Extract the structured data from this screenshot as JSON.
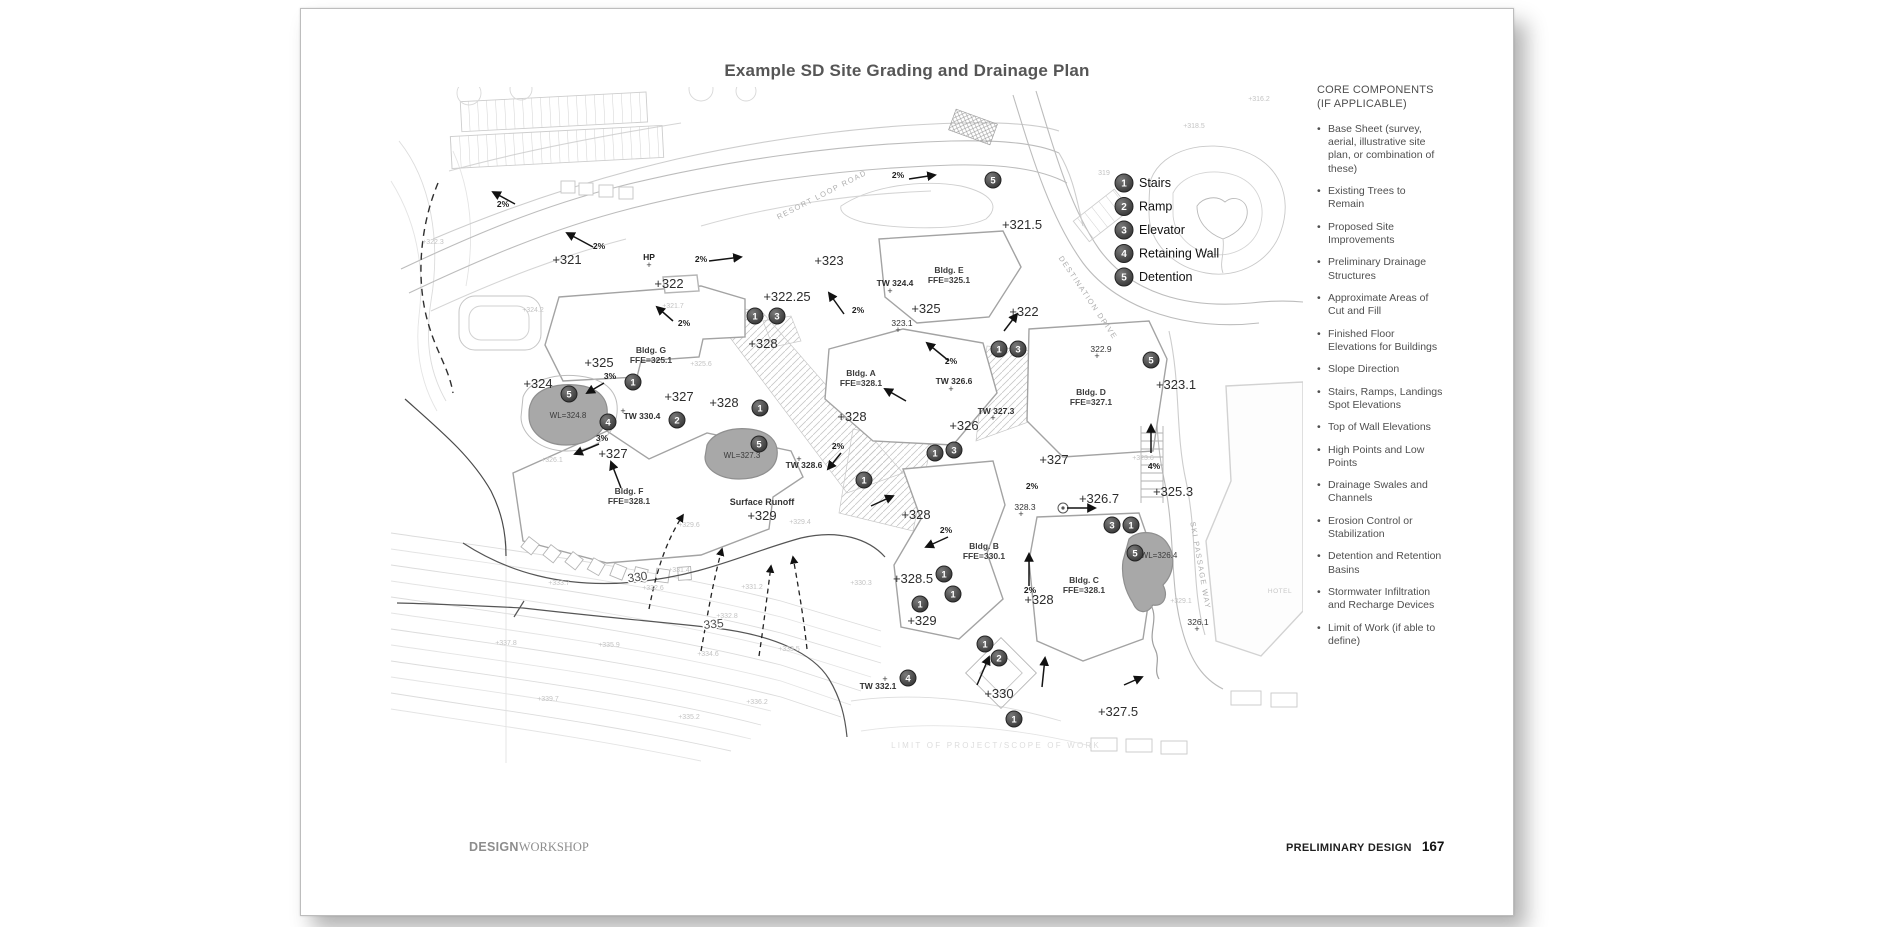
{
  "page": {
    "title": "Example SD Site Grading and Drainage Plan",
    "footer": {
      "brand_bold": "DESIGN",
      "brand_serif": "WORKSHOP",
      "section_label": "PRELIMINARY DESIGN",
      "page_number": "167"
    }
  },
  "legend": {
    "items": [
      {
        "num": "1",
        "label": "Stairs"
      },
      {
        "num": "2",
        "label": "Ramp"
      },
      {
        "num": "3",
        "label": "Elevator"
      },
      {
        "num": "4",
        "label": "Retaining Wall"
      },
      {
        "num": "5",
        "label": "Detention"
      }
    ]
  },
  "sidebar": {
    "heading_line1": "CORE COMPONENTS",
    "heading_line2": "(IF APPLICABLE)",
    "items": [
      "Base Sheet (survey, aerial, illustrative site plan, or combination of these)",
      "Existing Trees to Remain",
      "Proposed Site Improvements",
      "Preliminary Drainage Structures",
      "Approximate Areas of Cut and Fill",
      "Finished Floor Elevations for Buildings",
      "Slope Direction",
      "Stairs, Ramps, Landings Spot Elevations",
      "Top of Wall Elevations",
      "High Points and Low Points",
      "Drainage Swales and Channels",
      "Erosion Control or Stabilization",
      "Detention and Retention Basins",
      "Stormwater Infiltration and Recharge Devices",
      "Limit of Work (if able to define)"
    ]
  },
  "plan": {
    "labels": [
      {
        "t": "+321",
        "x": 566,
        "y": 263,
        "c": "spot"
      },
      {
        "t": "+322",
        "x": 668,
        "y": 287,
        "c": "spot"
      },
      {
        "t": "+322.25",
        "x": 786,
        "y": 300,
        "c": "spot"
      },
      {
        "t": "+323",
        "x": 828,
        "y": 264,
        "c": "spot"
      },
      {
        "t": "+321.5",
        "x": 1021,
        "y": 228,
        "c": "spot"
      },
      {
        "t": "+322",
        "x": 1023,
        "y": 315,
        "c": "spot"
      },
      {
        "t": "+325",
        "x": 925,
        "y": 312,
        "c": "spot"
      },
      {
        "t": "+325",
        "x": 598,
        "y": 366,
        "c": "spot"
      },
      {
        "t": "+324",
        "x": 537,
        "y": 387,
        "c": "spot"
      },
      {
        "t": "+327",
        "x": 678,
        "y": 400,
        "c": "spot"
      },
      {
        "t": "+328",
        "x": 723,
        "y": 406,
        "c": "spot"
      },
      {
        "t": "+328",
        "x": 762,
        "y": 347,
        "c": "spot"
      },
      {
        "t": "+327",
        "x": 612,
        "y": 457,
        "c": "spot"
      },
      {
        "t": "+326",
        "x": 963,
        "y": 429,
        "c": "spot"
      },
      {
        "t": "+328",
        "x": 851,
        "y": 420,
        "c": "spot"
      },
      {
        "t": "+327",
        "x": 1053,
        "y": 463,
        "c": "spot"
      },
      {
        "t": "+326.7",
        "x": 1098,
        "y": 502,
        "c": "spot"
      },
      {
        "t": "+325.3",
        "x": 1172,
        "y": 495,
        "c": "spot"
      },
      {
        "t": "+323.1",
        "x": 1175,
        "y": 388,
        "c": "spot"
      },
      {
        "t": "+328",
        "x": 915,
        "y": 518,
        "c": "spot"
      },
      {
        "t": "+328.5",
        "x": 912,
        "y": 582,
        "c": "spot"
      },
      {
        "t": "+329",
        "x": 761,
        "y": 519,
        "c": "spot"
      },
      {
        "t": "+329",
        "x": 921,
        "y": 624,
        "c": "spot"
      },
      {
        "t": "+328",
        "x": 1038,
        "y": 603,
        "c": "spot"
      },
      {
        "t": "+330",
        "x": 998,
        "y": 697,
        "c": "spot"
      },
      {
        "t": "+327.5",
        "x": 1117,
        "y": 715,
        "c": "spot"
      },
      {
        "t": "322.9",
        "x": 1100,
        "y": 351,
        "c": "sm"
      },
      {
        "t": "323.1",
        "x": 901,
        "y": 325,
        "c": "sm"
      },
      {
        "t": "328.3",
        "x": 1024,
        "y": 509,
        "c": "sm"
      },
      {
        "t": "326.1",
        "x": 1197,
        "y": 624,
        "c": "sm"
      },
      {
        "t": "+",
        "x": 1096,
        "y": 358,
        "c": "plus"
      },
      {
        "t": "+",
        "x": 897,
        "y": 332,
        "c": "plus"
      },
      {
        "t": "+",
        "x": 1020,
        "y": 516,
        "c": "plus"
      },
      {
        "t": "+",
        "x": 1196,
        "y": 631,
        "c": "plus"
      },
      {
        "t": "+",
        "x": 889,
        "y": 293,
        "c": "plus"
      },
      {
        "t": "+",
        "x": 950,
        "y": 391,
        "c": "plus"
      },
      {
        "t": "+",
        "x": 992,
        "y": 420,
        "c": "plus"
      },
      {
        "t": "+",
        "x": 798,
        "y": 461,
        "c": "plus"
      },
      {
        "t": "+",
        "x": 884,
        "y": 681,
        "c": "plus"
      },
      {
        "t": "+",
        "x": 622,
        "y": 413,
        "c": "plus"
      },
      {
        "t": "+",
        "x": 648,
        "y": 267,
        "c": "plus"
      },
      {
        "t": "TW 324.4",
        "x": 894,
        "y": 285,
        "c": "tw"
      },
      {
        "t": "TW 330.4",
        "x": 641,
        "y": 418,
        "c": "tw"
      },
      {
        "t": "TW 328.6",
        "x": 803,
        "y": 467,
        "c": "tw"
      },
      {
        "t": "TW 326.6",
        "x": 953,
        "y": 383,
        "c": "tw"
      },
      {
        "t": "TW 327.3",
        "x": 995,
        "y": 413,
        "c": "tw"
      },
      {
        "t": "TW 332.1",
        "x": 877,
        "y": 688,
        "c": "tw"
      },
      {
        "t": "Bldg. G",
        "x": 650,
        "y": 352,
        "c": "bldg"
      },
      {
        "t": "FFE=325.1",
        "x": 650,
        "y": 362,
        "c": "bldg"
      },
      {
        "t": "Bldg. A",
        "x": 860,
        "y": 375,
        "c": "bldg"
      },
      {
        "t": "FFE=328.1",
        "x": 860,
        "y": 385,
        "c": "bldg"
      },
      {
        "t": "Bldg. E",
        "x": 948,
        "y": 272,
        "c": "bldg"
      },
      {
        "t": "FFE=325.1",
        "x": 948,
        "y": 282,
        "c": "bldg"
      },
      {
        "t": "Bldg. D",
        "x": 1090,
        "y": 394,
        "c": "bldg"
      },
      {
        "t": "FFE=327.1",
        "x": 1090,
        "y": 404,
        "c": "bldg"
      },
      {
        "t": "Bldg. F",
        "x": 628,
        "y": 493,
        "c": "bldg"
      },
      {
        "t": "FFE=328.1",
        "x": 628,
        "y": 503,
        "c": "bldg"
      },
      {
        "t": "Bldg. B",
        "x": 983,
        "y": 548,
        "c": "bldg"
      },
      {
        "t": "FFE=330.1",
        "x": 983,
        "y": 558,
        "c": "bldg"
      },
      {
        "t": "Bldg. C",
        "x": 1083,
        "y": 582,
        "c": "bldg"
      },
      {
        "t": "FFE=328.1",
        "x": 1083,
        "y": 592,
        "c": "bldg"
      },
      {
        "t": "2%",
        "x": 598,
        "y": 248,
        "c": "pct"
      },
      {
        "t": "2%",
        "x": 700,
        "y": 261,
        "c": "pct"
      },
      {
        "t": "2%",
        "x": 897,
        "y": 177,
        "c": "pct"
      },
      {
        "t": "2%",
        "x": 502,
        "y": 206,
        "c": "pct"
      },
      {
        "t": "2%",
        "x": 683,
        "y": 325,
        "c": "pct"
      },
      {
        "t": "2%",
        "x": 857,
        "y": 312,
        "c": "pct"
      },
      {
        "t": "2%",
        "x": 950,
        "y": 363,
        "c": "pct"
      },
      {
        "t": "3%",
        "x": 609,
        "y": 378,
        "c": "pct"
      },
      {
        "t": "3%",
        "x": 601,
        "y": 440,
        "c": "pct"
      },
      {
        "t": "2%",
        "x": 837,
        "y": 448,
        "c": "pct"
      },
      {
        "t": "2%",
        "x": 945,
        "y": 532,
        "c": "pct"
      },
      {
        "t": "2%",
        "x": 1031,
        "y": 488,
        "c": "pct"
      },
      {
        "t": "2%",
        "x": 1029,
        "y": 592,
        "c": "pct"
      },
      {
        "t": "4%",
        "x": 1153,
        "y": 468,
        "c": "pct"
      },
      {
        "t": "HP",
        "x": 648,
        "y": 259,
        "c": "pct"
      },
      {
        "t": "WL=324.8",
        "x": 567,
        "y": 417,
        "c": "wl"
      },
      {
        "t": "WL=327.3",
        "x": 741,
        "y": 457,
        "c": "wl"
      },
      {
        "t": "WL=326.4",
        "x": 1158,
        "y": 557,
        "c": "wl"
      },
      {
        "t": "RESORT LOOP ROAD",
        "x": 822,
        "y": 196,
        "c": "street",
        "r": -27
      },
      {
        "t": "DESTINATION DRIVE",
        "x": 1085,
        "y": 298,
        "c": "street",
        "r": 56
      },
      {
        "t": "SKI PASSAGE WAY",
        "x": 1197,
        "y": 565,
        "c": "street",
        "r": 80
      },
      {
        "t": "HOTEL",
        "x": 1279,
        "y": 592,
        "c": "hotel"
      },
      {
        "t": "LIMIT OF PROJECT/SCOPE OF WORK",
        "x": 995,
        "y": 747,
        "c": "limit"
      },
      {
        "t": "330",
        "x": 637,
        "y": 580,
        "c": "contour",
        "r": -8
      },
      {
        "t": "335",
        "x": 713,
        "y": 627,
        "c": "contour",
        "r": -6
      },
      {
        "t": "Surface Runoff",
        "x": 761,
        "y": 504,
        "c": "misc"
      },
      {
        "t": "+318.5",
        "x": 1193,
        "y": 127,
        "c": "faint"
      },
      {
        "t": "319",
        "x": 1103,
        "y": 174,
        "c": "faint"
      },
      {
        "t": "+316.2",
        "x": 1258,
        "y": 100,
        "c": "faint"
      },
      {
        "t": "+321.7",
        "x": 672,
        "y": 307,
        "c": "faint"
      },
      {
        "t": "+322.3",
        "x": 432,
        "y": 243,
        "c": "faint"
      },
      {
        "t": "+324.2",
        "x": 532,
        "y": 311,
        "c": "faint"
      },
      {
        "t": "+325.6",
        "x": 700,
        "y": 365,
        "c": "faint"
      },
      {
        "t": "+326.1",
        "x": 551,
        "y": 461,
        "c": "faint"
      },
      {
        "t": "+329.6",
        "x": 688,
        "y": 526,
        "c": "faint"
      },
      {
        "t": "+329.4",
        "x": 799,
        "y": 523,
        "c": "faint"
      },
      {
        "t": "+330.3",
        "x": 860,
        "y": 584,
        "c": "faint"
      },
      {
        "t": "+331.4",
        "x": 678,
        "y": 571,
        "c": "faint"
      },
      {
        "t": "+332.6",
        "x": 652,
        "y": 589,
        "c": "faint"
      },
      {
        "t": "+333.7",
        "x": 558,
        "y": 584,
        "c": "faint"
      },
      {
        "t": "+331.2",
        "x": 751,
        "y": 588,
        "c": "faint"
      },
      {
        "t": "+332.8",
        "x": 726,
        "y": 617,
        "c": "faint"
      },
      {
        "t": "+335.9",
        "x": 608,
        "y": 646,
        "c": "faint"
      },
      {
        "t": "+334.6",
        "x": 707,
        "y": 655,
        "c": "faint"
      },
      {
        "t": "+333.5",
        "x": 788,
        "y": 650,
        "c": "faint"
      },
      {
        "t": "+337.8",
        "x": 505,
        "y": 644,
        "c": "faint"
      },
      {
        "t": "+339.7",
        "x": 547,
        "y": 700,
        "c": "faint"
      },
      {
        "t": "+336.2",
        "x": 756,
        "y": 703,
        "c": "faint"
      },
      {
        "t": "+335.2",
        "x": 688,
        "y": 718,
        "c": "faint"
      },
      {
        "t": "+323.6",
        "x": 1142,
        "y": 459,
        "c": "faint"
      },
      {
        "t": "+329.1",
        "x": 1180,
        "y": 602,
        "c": "faint"
      }
    ],
    "markers": [
      [
        992,
        179,
        "5"
      ],
      [
        754,
        315,
        "1"
      ],
      [
        776,
        315,
        "3"
      ],
      [
        632,
        381,
        "1"
      ],
      [
        568,
        393,
        "5"
      ],
      [
        759,
        407,
        "1"
      ],
      [
        607,
        421,
        "4"
      ],
      [
        676,
        419,
        "2"
      ],
      [
        998,
        348,
        "1"
      ],
      [
        1017,
        348,
        "3"
      ],
      [
        934,
        452,
        "1"
      ],
      [
        953,
        449,
        "3"
      ],
      [
        863,
        479,
        "1"
      ],
      [
        758,
        443,
        "5"
      ],
      [
        1111,
        524,
        "3"
      ],
      [
        1130,
        524,
        "1"
      ],
      [
        1134,
        552,
        "5"
      ],
      [
        943,
        573,
        "1"
      ],
      [
        952,
        593,
        "1"
      ],
      [
        919,
        603,
        "1"
      ],
      [
        984,
        643,
        "1"
      ],
      [
        998,
        657,
        "2"
      ],
      [
        907,
        677,
        "4"
      ],
      [
        1013,
        718,
        "1"
      ],
      [
        1150,
        359,
        "5"
      ]
    ],
    "arrows": [
      [
        592,
        246,
        566,
        232
      ],
      [
        708,
        260,
        740,
        256
      ],
      [
        908,
        178,
        934,
        174
      ],
      [
        514,
        203,
        492,
        191
      ],
      [
        672,
        320,
        656,
        306
      ],
      [
        948,
        360,
        926,
        342
      ],
      [
        843,
        313,
        828,
        292
      ],
      [
        1003,
        330,
        1016,
        313
      ],
      [
        905,
        400,
        884,
        388
      ],
      [
        603,
        382,
        586,
        392
      ],
      [
        598,
        443,
        574,
        453
      ],
      [
        620,
        487,
        610,
        461
      ],
      [
        840,
        452,
        827,
        468
      ],
      [
        870,
        505,
        892,
        495
      ],
      [
        947,
        536,
        925,
        546
      ],
      [
        1028,
        585,
        1028,
        553
      ],
      [
        1066,
        507,
        1094,
        507
      ],
      [
        1123,
        684,
        1141,
        676
      ],
      [
        976,
        684,
        988,
        656
      ],
      [
        1041,
        686,
        1044,
        657
      ],
      [
        1150,
        452,
        1150,
        424
      ]
    ],
    "runoff": [
      "M 648,608 C 655,572 664,542 682,514",
      "M 700,650 C 707,612 712,580 721,548",
      "M 758,655 C 763,622 766,595 770,565",
      "M 806,648 C 802,612 797,584 792,556"
    ]
  }
}
